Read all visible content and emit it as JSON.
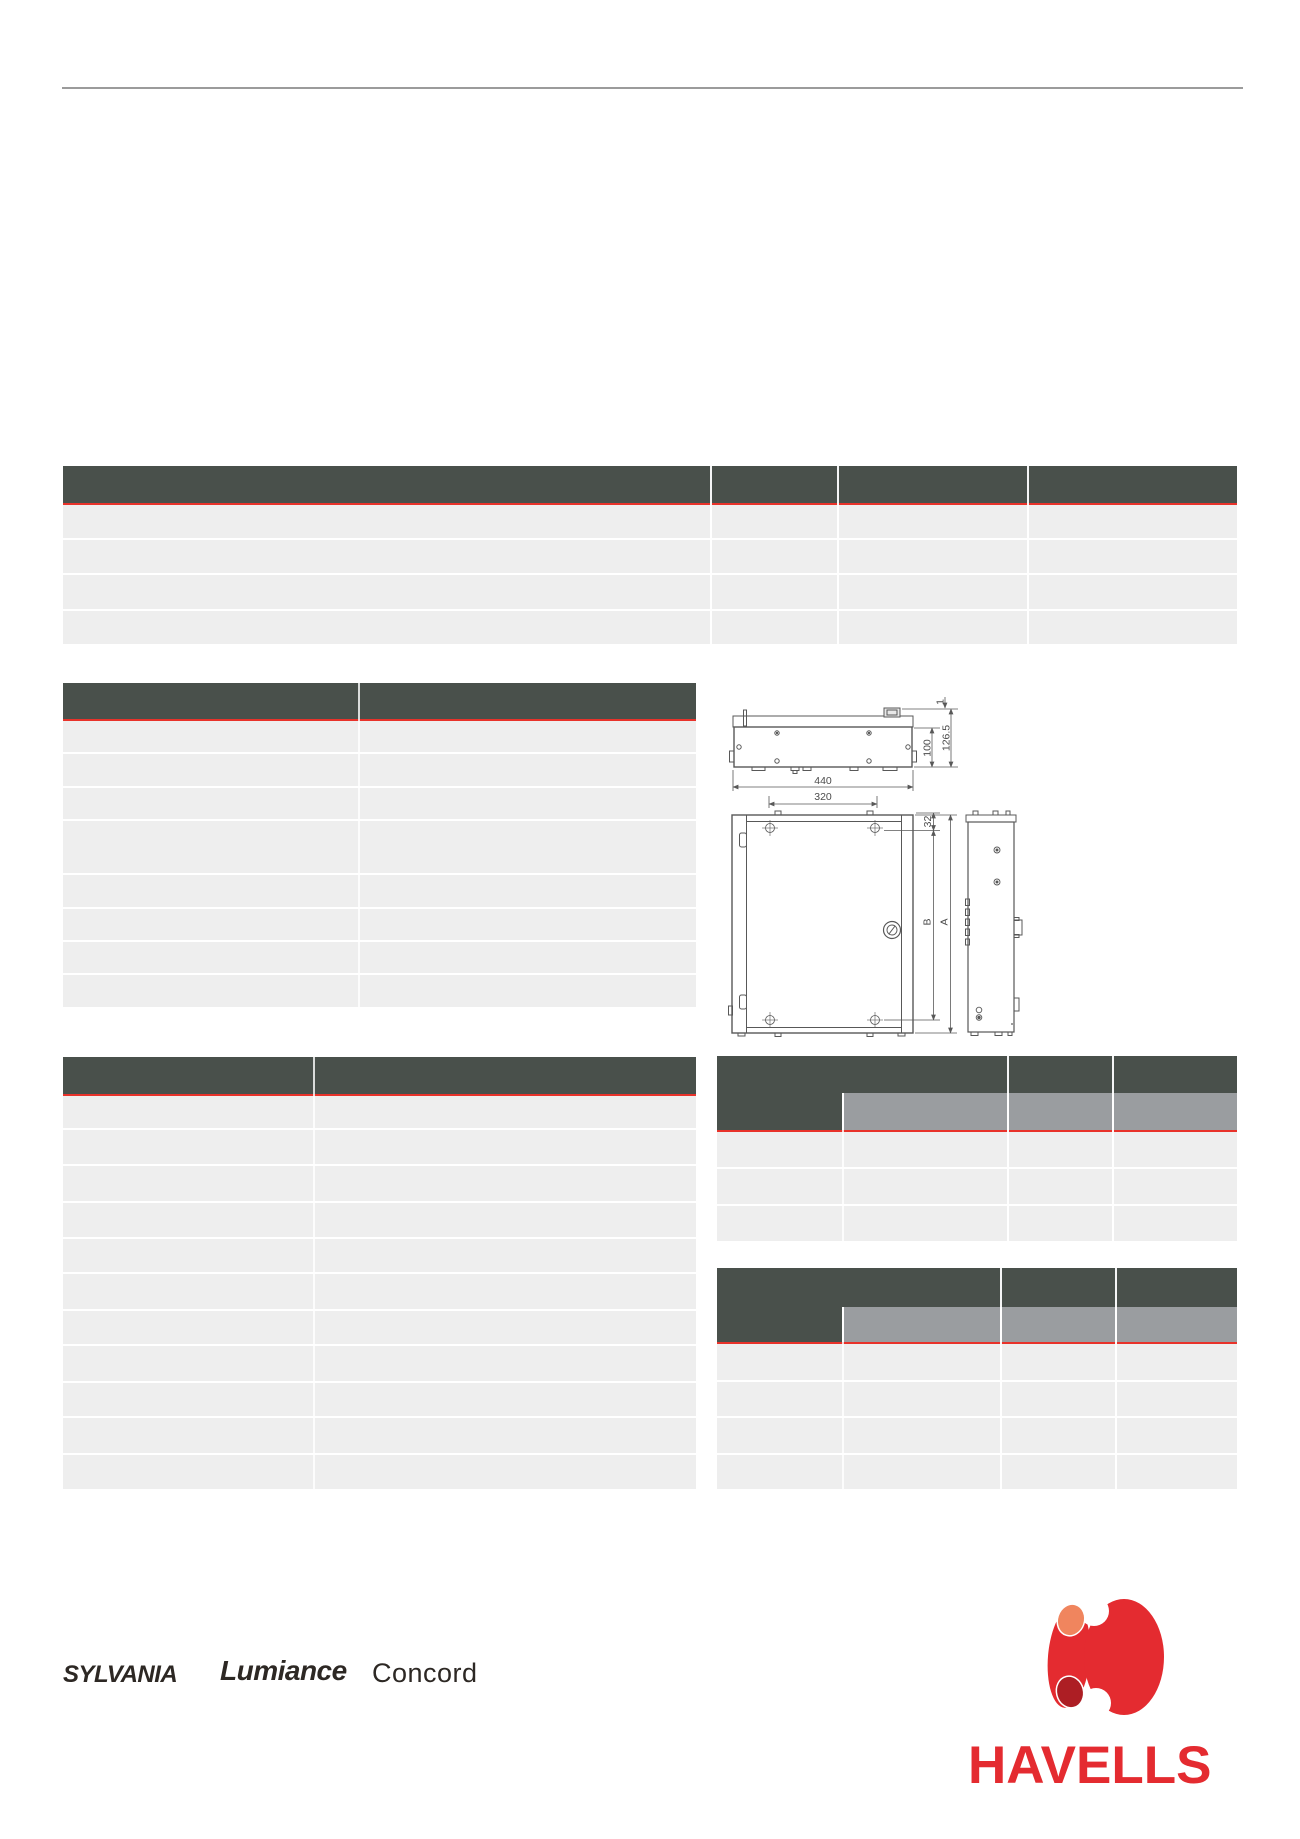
{
  "colors": {
    "header_dark": "#49504b",
    "accent_red": "#e8322a",
    "row_gray": "#eeeeee",
    "subheader_gray": "#9a9da0",
    "rule_gray": "#9b9b9b",
    "brand_text": "#2d2824",
    "havells_red": "#e42b30",
    "havells_orange": "#f0855e",
    "havells_dark_red": "#ad1e24",
    "drawing_line": "#585858"
  },
  "tables": {
    "spec_top": {
      "row_heights": [
        33,
        33,
        34,
        33
      ]
    },
    "spec_left": {
      "row_heights": [
        31,
        32,
        31,
        52,
        32,
        31,
        31,
        32
      ]
    },
    "spec_bottom": {
      "row_heights": [
        32,
        34,
        35,
        34,
        33,
        35,
        33,
        35,
        33,
        35,
        34
      ]
    },
    "order_a": {
      "row_heights": [
        35,
        35,
        35
      ]
    },
    "order_b": {
      "row_heights": [
        36,
        34,
        35,
        34
      ]
    }
  },
  "drawing": {
    "dims": {
      "width": "440",
      "mounting_width": "320",
      "depth": "100",
      "total_depth": "126.5",
      "lip": "1",
      "top_hole_offset": "32",
      "hole_spacing": "B",
      "height": "A"
    }
  },
  "logos": {
    "sylvania": "SYLVANIA",
    "lumiance": "Lumiance",
    "concord": "Concord",
    "havells": "HAVELLS"
  }
}
